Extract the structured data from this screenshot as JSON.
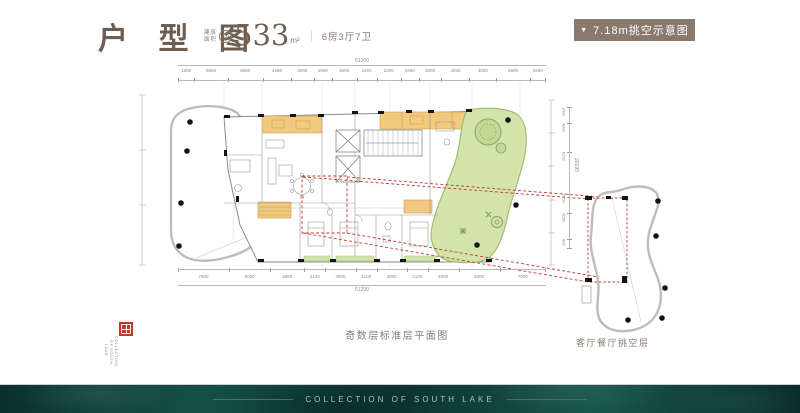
{
  "header": {
    "title": "户 型 图",
    "area_label_top": "建筑",
    "area_label_bottom": "面积",
    "area_approx": "约",
    "area_value": "533",
    "area_unit": "m²",
    "separator": "｜",
    "room_spec": "6房3厅7卫",
    "banner": {
      "arrow": "▼",
      "label": "7.18m挑空示意图"
    }
  },
  "plan": {
    "caption_main": "奇数层标准层平面图",
    "caption_side": "客厅餐厅挑空层",
    "dims_top": {
      "total": "51200",
      "segments": [
        "1500",
        "5500",
        "6000",
        "4250",
        "3000",
        "1900",
        "3500",
        "2400",
        "3300",
        "1900",
        "3000",
        "4250",
        "4000",
        "5500",
        "1500"
      ]
    },
    "dims_bottom": {
      "total": "51200",
      "segments": [
        "7900",
        "6000",
        "4650",
        "2130",
        "3900",
        "2100",
        "3900",
        "2100",
        "4000",
        "6000",
        "7000"
      ]
    },
    "dims_side": {
      "total": "20190",
      "segments": [
        "1600",
        "4800",
        "8150",
        "2350",
        "4050",
        "800"
      ]
    }
  },
  "seal": {
    "columns": [
      "COLLECTION",
      "OF SOUTH",
      "LAKE"
    ]
  },
  "footer": {
    "text": "COLLECTION OF SOUTH LAKE"
  },
  "colors": {
    "title": "#6e5e52",
    "caption": "#8a7a6e",
    "banner_bg": "#8a796d",
    "banner_text": "#ffffff",
    "accent_red": "#c13a2c",
    "orange": "#f3c97e",
    "green": "#d3e4ab",
    "green_stroke": "#9fbd78",
    "footer_bg": "#0e3631",
    "footer_text": "#a9c4bc",
    "dim": "#8a8a8a",
    "seal_red": "#c2392b"
  }
}
